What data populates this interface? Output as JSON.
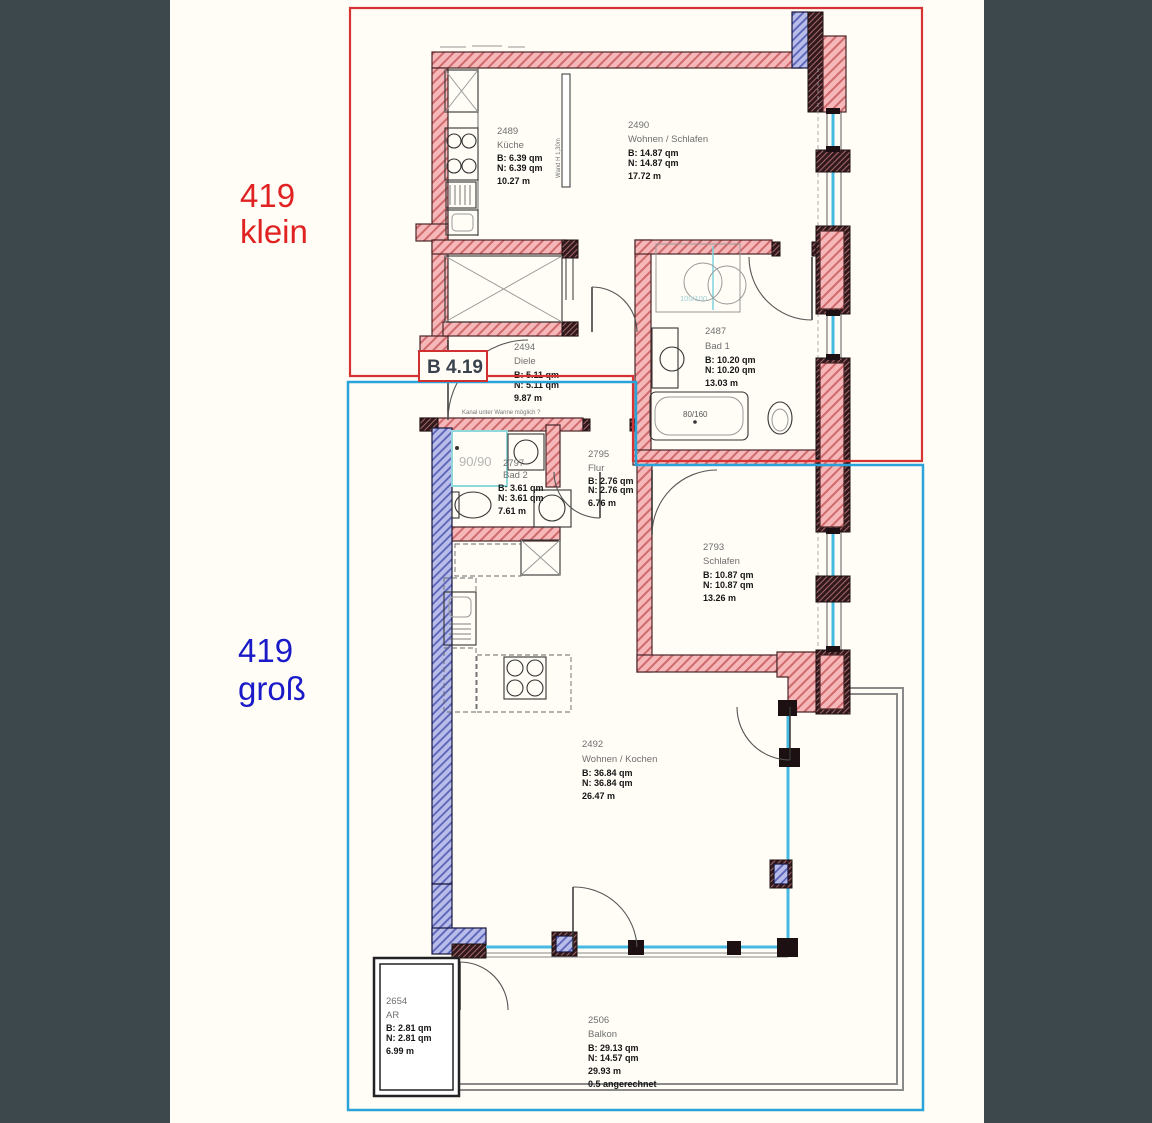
{
  "sheet": {
    "background_color": "#3d484c",
    "paper_color": "#fffdf6",
    "plan_label": "B 4.19"
  },
  "overlays": {
    "klein": {
      "number": "419",
      "size": "klein",
      "text_color": "#e02222",
      "outline_color": "#d63434"
    },
    "gross": {
      "number": "419",
      "size": "groß",
      "text_color": "#1a1ac8",
      "outline_color": "#2aa3da"
    }
  },
  "rooms": [
    {
      "number": "2489",
      "name": "Küche",
      "b": "B: 6.39 qm",
      "n": "N: 6.39 qm",
      "len": "10.27 m"
    },
    {
      "number": "2490",
      "name": "Wohnen / Schlafen",
      "b": "B: 14.87 qm",
      "n": "N: 14.87 qm",
      "len": "17.72 m"
    },
    {
      "number": "2487",
      "name": "Bad 1",
      "b": "B: 10.20 qm",
      "n": "N: 10.20 qm",
      "len": "13.03 m"
    },
    {
      "number": "2494",
      "name": "Diele",
      "b": "B: 5.11 qm",
      "n": "N: 5.11 qm",
      "len": "9.87 m"
    },
    {
      "number": "2797",
      "name": "Bad 2",
      "b": "B: 3.61 qm",
      "n": "N: 3.61 qm",
      "len": "7.61 m"
    },
    {
      "number": "2795",
      "name": "Flur",
      "b": "B: 2.76 qm",
      "n": "N: 2.76 qm",
      "len": "6.76 m"
    },
    {
      "number": "2793",
      "name": "Schlafen",
      "b": "B: 10.87 qm",
      "n": "N: 10.87 qm",
      "len": "13.26 m"
    },
    {
      "number": "2492",
      "name": "Wohnen / Kochen",
      "b": "B: 36.84 qm",
      "n": "N: 36.84 qm",
      "len": "26.47 m"
    },
    {
      "number": "2654",
      "name": "AR",
      "b": "B: 2.81 qm",
      "n": "N: 2.81 qm",
      "len": "6.99 m"
    },
    {
      "number": "2506",
      "name": "Balkon",
      "b": "B: 29.13 qm",
      "n": "N: 14.57 qm",
      "len": "29.93 m",
      "note": "0.5 angerechnet"
    }
  ],
  "fixtures": {
    "bathtub_label": "80/160",
    "shower_bad1_label": "100/100",
    "shower_bad2_label": "90/90",
    "duct_note": "Kanal unter Wanne möglich ?",
    "low_wall_note": "Wand H 1,30m"
  }
}
